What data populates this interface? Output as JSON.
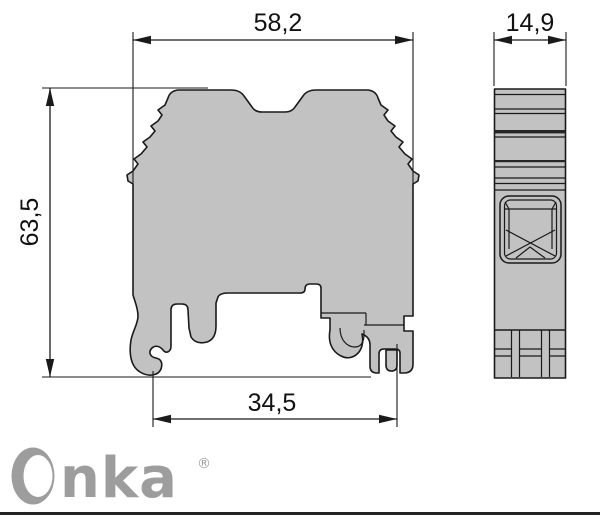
{
  "dimensions": {
    "front_width": {
      "label": "58,2"
    },
    "side_width": {
      "label": "14,9"
    },
    "front_height": {
      "label": "63,5"
    },
    "rail_width": {
      "label": "34,5"
    }
  },
  "logo": {
    "brand": "Onka",
    "text_part": "nka",
    "registered_mark": "®"
  },
  "colors": {
    "body_fill": "#c2c2c2",
    "outline": "#1a1a1a",
    "dim_line": "#1a1a1a",
    "logo_gray": "#9d9d9d",
    "footer_bar": "#232323",
    "detail_dark": "#262626"
  }
}
